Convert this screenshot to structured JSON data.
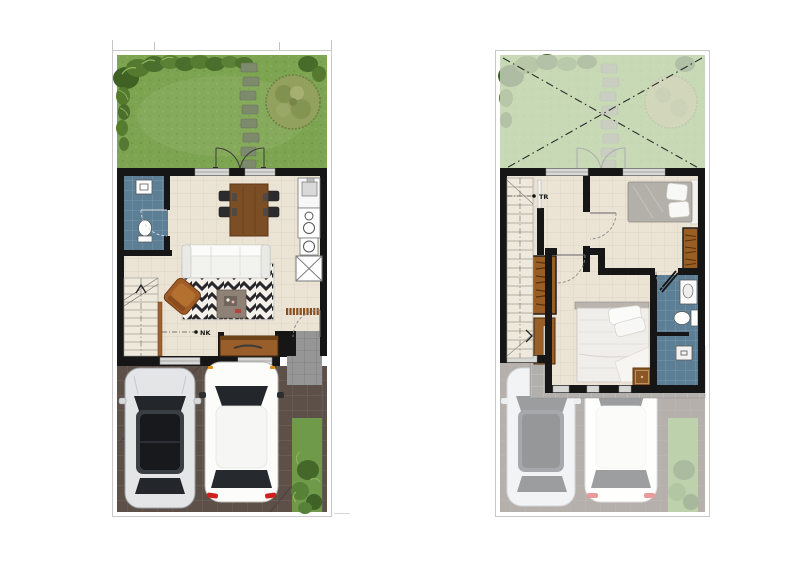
{
  "page": {
    "background": "#ffffff"
  },
  "plans": {
    "first_floor": {
      "stair_label": "NK"
    },
    "second_floor": {
      "stair_label": "TR"
    }
  },
  "colors": {
    "wall": "#161616",
    "floor": "#ebe3d4",
    "garden": "#7da450",
    "garden_faded": "#ccd8b5",
    "bathroom_tile": "#5d7f96",
    "driveway": "#5d5049",
    "driveway_faded": "#dcdad7",
    "porch": "#969696",
    "ledge": "#b2b0ad",
    "wood": "#9a5e25",
    "sofa": "#f2f2ef",
    "rug_stripe": "#27272b",
    "tree": "#93a15e",
    "taillight_red": "#cf1f1f"
  }
}
